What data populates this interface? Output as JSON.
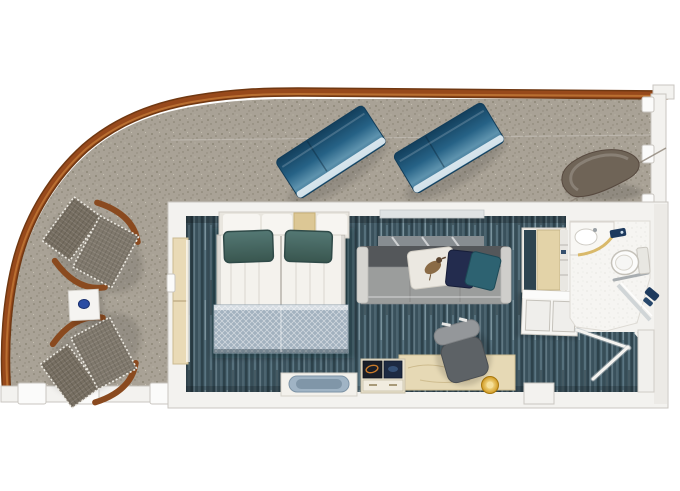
{
  "scene": {
    "type": "floor-plan",
    "subject": "cruise-ship cabin with wrap-around balcony",
    "areas": [
      "balcony-terrace",
      "bedroom",
      "sitting-area",
      "desk-area",
      "wardrobe",
      "bathroom",
      "entry-corridor"
    ],
    "furniture": {
      "balcony": [
        "sun-lounger",
        "sun-lounger",
        "curved-lounge-chair",
        "deck-chair",
        "deck-chair",
        "side-table"
      ],
      "bedroom": [
        "double-bed",
        "two-teal-pillows",
        "patterned-blanket",
        "headboard-shelf",
        "foot-bench"
      ],
      "sitting-area": [
        "sofa",
        "bird-print-cushion",
        "navy-cushion",
        "teal-cushion",
        "curtained-window"
      ],
      "desk-area": [
        "desk",
        "desk-chair",
        "media-console",
        "round-gold-lamp"
      ],
      "wardrobe": [
        "closet-niche",
        "dresser"
      ],
      "bathroom": [
        "vanity-counter",
        "sink",
        "toilet",
        "shower",
        "towel-bar",
        "door-swings"
      ]
    }
  },
  "colors": {
    "bg": "#ffffff",
    "deck": "#a9a296",
    "deck_dot": "#68624f",
    "deck_dot_light": "#cdc7b8",
    "railing": "#97491b",
    "railing_dark": "#703812",
    "railing_light": "#bc7334",
    "wall": "#f3f2ef",
    "wall_stroke": "#c9c6c0",
    "post": "#fbfbfa",
    "carpet": "#415a66",
    "lounger_deep": "#133f5c",
    "lounger_mid": "#266286",
    "lounger_light": "#5e93ae",
    "lounger_edge": "#2b6488",
    "mesh": "#766e61",
    "wood": "#8a4a1f",
    "table": "#f5f4f1",
    "table_dot": "#2b4da3",
    "sheet": "#f4f2ed",
    "pillow_hi": "#547874",
    "pillow_lo": "#39564f",
    "blanket": "#a3b2bf",
    "headboard_tan": "#dcc795",
    "sofa_back": "#54575a",
    "sofa_seat": "#9b9d9c",
    "sofa_arm": "#d6d5d1",
    "cushion_white": "#ebe8e1",
    "cushion_navy": "#232c4e",
    "cushion_teal": "#2d6271",
    "curtain": "#878d91",
    "desk": "#e6d9b5",
    "desk_edge": "#cdbd92",
    "gold_hi": "#f8e49b",
    "gold_lo": "#d19920",
    "console": "#ebe4d1",
    "art_dark": "#191e28",
    "art_navy": "#1d2a42",
    "bench_cushion": "#a0b4c5",
    "chair_seat": "#5d6266",
    "chair_back": "#94979a",
    "closet_wood": "#e3d3a8",
    "closet_side": "#2e4450",
    "bath_floor": "#f6f5f2",
    "porcelain": "#fcfcfb",
    "fixture_blue": "#1d3a5e",
    "curved_chair": "#6f6457",
    "door_tan": "#e9dab6"
  }
}
